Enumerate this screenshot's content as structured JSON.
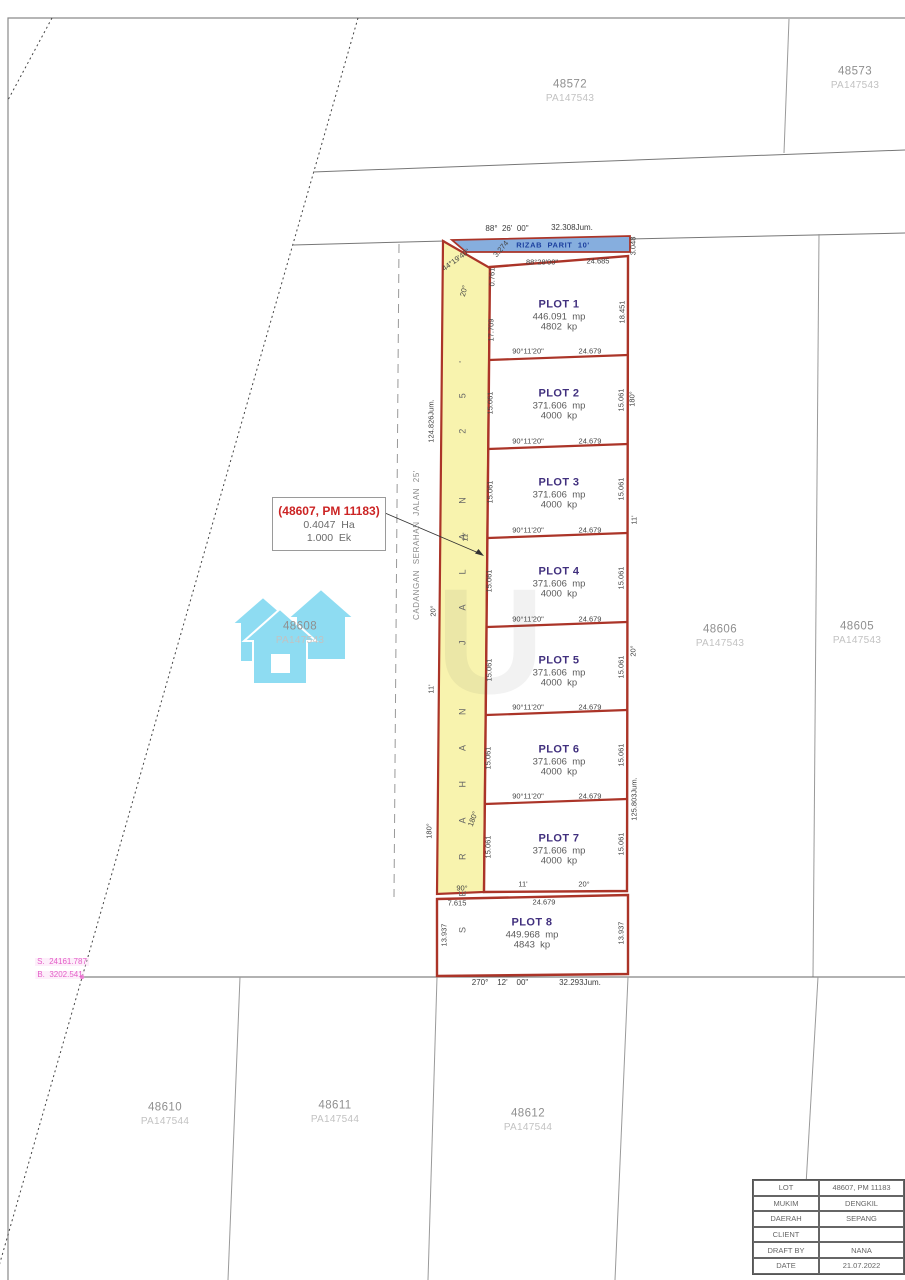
{
  "top_lots": [
    {
      "number": "48572",
      "pa": "PA147543"
    },
    {
      "number": "48573",
      "pa": "PA147543"
    }
  ],
  "mid_lots": [
    {
      "number": "48608",
      "pa": "PA147543"
    },
    {
      "number": "48606",
      "pa": "PA147543"
    },
    {
      "number": "48605",
      "pa": "PA147543"
    }
  ],
  "bottom_lots": [
    {
      "number": "48610",
      "pa": "PA147544"
    },
    {
      "number": "48611",
      "pa": "PA147544"
    },
    {
      "number": "48612",
      "pa": "PA147544"
    }
  ],
  "annotation_box": {
    "title": "(48607, PM 11183)",
    "area_ha": "0.4047  Ha",
    "area_ek": "1.000  Ek"
  },
  "rizab_parit": "RIZAB  PARIT  10'",
  "road": {
    "name": "S E R A H A N   J A L A N   2 5 '",
    "cadangan": "CADANGAN  SERAHAN  JALAN  25'",
    "length": "124.826Jum.",
    "a20_top": "20°",
    "a20": "20°",
    "a11": "11'",
    "a11_mid": "11'",
    "a180": "180°",
    "a180_in": "180°",
    "a90": "90°",
    "top_angle": "44°19'40\"",
    "d0761": "0.761",
    "d3274": "3.274"
  },
  "bearings": {
    "top": "88°  26'  00\"",
    "top_total": "32.308Jum.",
    "bottom": "270°    12'    00\"",
    "bottom_total": "32.293Jum."
  },
  "right_labels": {
    "d3048": "3.048",
    "a180": "180°",
    "a11": "11'",
    "a20": "20°",
    "jum": "125.803Jum."
  },
  "plots": [
    {
      "name": "PLOT 1",
      "mp": "446.091  mp",
      "kp": "4802  kp",
      "left": "17.709",
      "right": "18.451",
      "top_bearing": "88°28'00\"",
      "top_dist": "24.685",
      "bottom_bearing": "90°11'20\"",
      "bottom_dist": "24.679"
    },
    {
      "name": "PLOT 2",
      "mp": "371.606  mp",
      "kp": "4000  kp",
      "left": "15.061",
      "right": "15.061",
      "bottom_bearing": "90°11'20\"",
      "bottom_dist": "24.679"
    },
    {
      "name": "PLOT 3",
      "mp": "371.606  mp",
      "kp": "4000  kp",
      "left": "15.061",
      "right": "15.061",
      "bottom_bearing": "90°11'20\"",
      "bottom_dist": "24.679"
    },
    {
      "name": "PLOT 4",
      "mp": "371.606  mp",
      "kp": "4000  kp",
      "left": "15.061",
      "right": "15.061",
      "bottom_bearing": "90°11'20\"",
      "bottom_dist": "24.679"
    },
    {
      "name": "PLOT 5",
      "mp": "371.606  mp",
      "kp": "4000  kp",
      "left": "15.061",
      "right": "15.061",
      "bottom_bearing": "90°11'20\"",
      "bottom_dist": "24.679"
    },
    {
      "name": "PLOT 6",
      "mp": "371.606  mp",
      "kp": "4000  kp",
      "left": "15.061",
      "right": "15.061",
      "bottom_bearing": "90°11'20\"",
      "bottom_dist": "24.679"
    },
    {
      "name": "PLOT 7",
      "mp": "371.606  mp",
      "kp": "4000  kp",
      "left": "15.061",
      "right": "15.061",
      "bottom_left": "11'",
      "bottom_right": "20°"
    },
    {
      "name": "PLOT 8",
      "mp": "449.968  mp",
      "kp": "4843  kp",
      "left": "13.937",
      "right": "13.937",
      "top_left": "7.615",
      "top_dist": "24.679"
    }
  ],
  "pink_coords": {
    "s": "S.  24161.787",
    "b": "B.  3202.541"
  },
  "watermark_letter": "U",
  "title_block": {
    "rows": [
      {
        "label": "LOT",
        "value": "48607,  PM  11183"
      },
      {
        "label": "MUKIM",
        "value": "DENGKIL"
      },
      {
        "label": "DAERAH",
        "value": "SEPANG"
      },
      {
        "label": "CLIENT",
        "value": ""
      },
      {
        "label": "DRAFT  BY",
        "value": "NANA"
      },
      {
        "label": "DATE",
        "value": "21.07.2022"
      }
    ]
  }
}
